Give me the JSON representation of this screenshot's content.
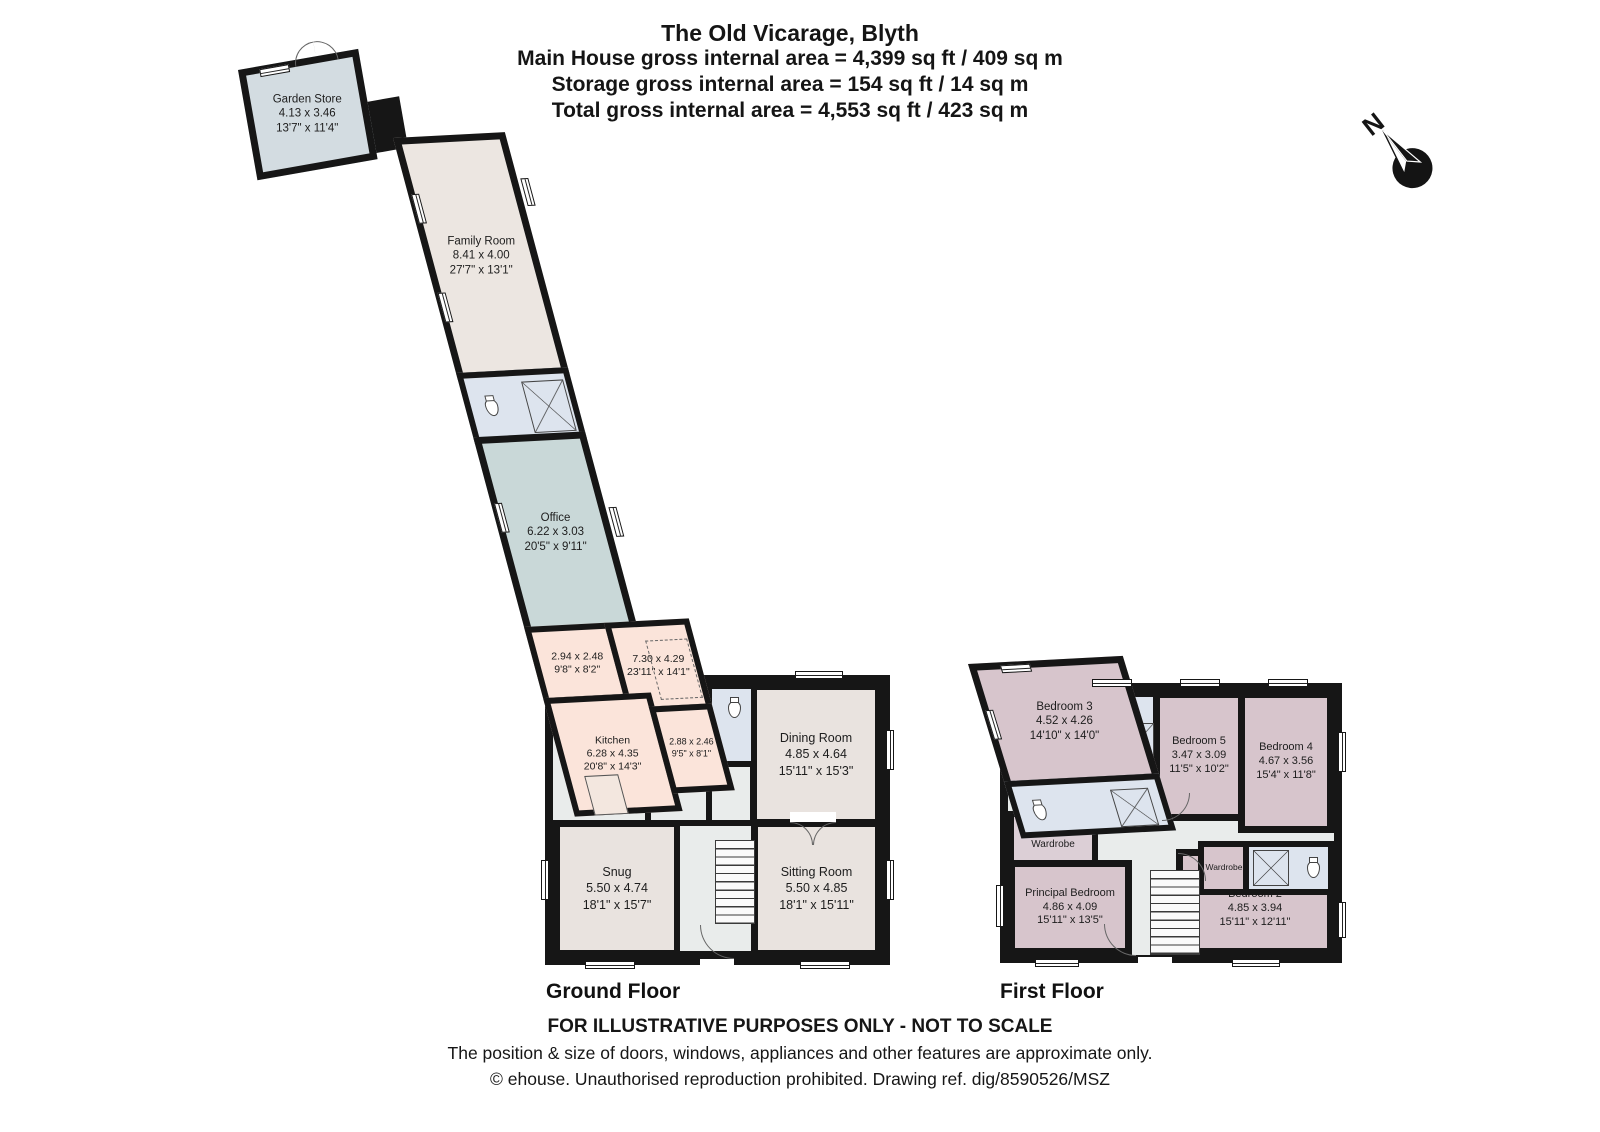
{
  "header": {
    "title": "The Old Vicarage, Blyth",
    "main_area": "Main House gross internal area = 4,399 sq ft / 409 sq m",
    "storage_area": "Storage gross internal area = 154 sq ft / 14 sq m",
    "total_area": "Total gross internal area = 4,553 sq ft / 423 sq m"
  },
  "compass": {
    "north_label": "N"
  },
  "floors": {
    "ground": "Ground Floor",
    "first": "First Floor"
  },
  "rooms": {
    "garden_store": {
      "name": "Garden Store",
      "metric": "4.13 x 3.46",
      "imperial": "13'7\" x 11'4\""
    },
    "family_room": {
      "name": "Family Room",
      "metric": "8.41 x 4.00",
      "imperial": "27'7\" x 13'1\""
    },
    "office": {
      "name": "Office",
      "metric": "6.22 x 3.03",
      "imperial": "20'5\" x 9'11\""
    },
    "pantry": {
      "metric": "2.94 x 2.48",
      "imperial": "9'8\" x 8'2\""
    },
    "open_plan": {
      "metric": "7.30 x 4.29",
      "imperial": "23'11\" x 14'1\""
    },
    "kitchen": {
      "name": "Kitchen",
      "metric": "6.28 x 4.35",
      "imperial": "20'8\" x 14'3\""
    },
    "boot_room": {
      "metric": "2.88 x 2.46",
      "imperial": "9'5\" x 8'1\""
    },
    "dining_room": {
      "name": "Dining Room",
      "metric": "4.85 x 4.64",
      "imperial": "15'11\" x 15'3\""
    },
    "snug": {
      "name": "Snug",
      "metric": "5.50 x 4.74",
      "imperial": "18'1\" x 15'7\""
    },
    "sitting_room": {
      "name": "Sitting Room",
      "metric": "5.50 x 4.85",
      "imperial": "18'1\" x 15'11\""
    },
    "bedroom3": {
      "name": "Bedroom 3",
      "metric": "4.52 x 4.26",
      "imperial": "14'10\" x 14'0\""
    },
    "bedroom5": {
      "name": "Bedroom 5",
      "metric": "3.47 x 3.09",
      "imperial": "11'5\" x 10'2\""
    },
    "bedroom4": {
      "name": "Bedroom 4",
      "metric": "4.67 x 3.56",
      "imperial": "15'4\" x 11'8\""
    },
    "walk_in_wardrobe": {
      "name": "Walk-In Wardrobe"
    },
    "principal_bedroom": {
      "name": "Principal Bedroom",
      "metric": "4.86 x 4.09",
      "imperial": "15'11\" x 13'5\""
    },
    "bedroom2": {
      "name": "Bedroom 2",
      "metric": "4.85 x 3.94",
      "imperial": "15'11\" x 12'11\""
    },
    "wardrobe": {
      "name": "Wardrobe"
    }
  },
  "footer": {
    "not_to_scale": "FOR ILLUSTRATIVE PURPOSES ONLY - NOT TO SCALE",
    "disclaimer": "The position & size of doors, windows, appliances and other features are approximate only.",
    "copyright": "© ehouse. Unauthorised reproduction prohibited. Drawing ref. dig/8590526/MSZ"
  },
  "colors": {
    "wall": "#161616",
    "bedroom_fill": "#d7c5cc",
    "bathroom_fill": "#dde4ee",
    "hall_fill": "#e9eceb",
    "kitchen_wing_fill": "#fbe4da",
    "reception_fill": "#e9e3df",
    "office_fill": "#c9d8d8",
    "store_fill": "#d3dce1",
    "family_room_fill": "#ece6e1"
  }
}
